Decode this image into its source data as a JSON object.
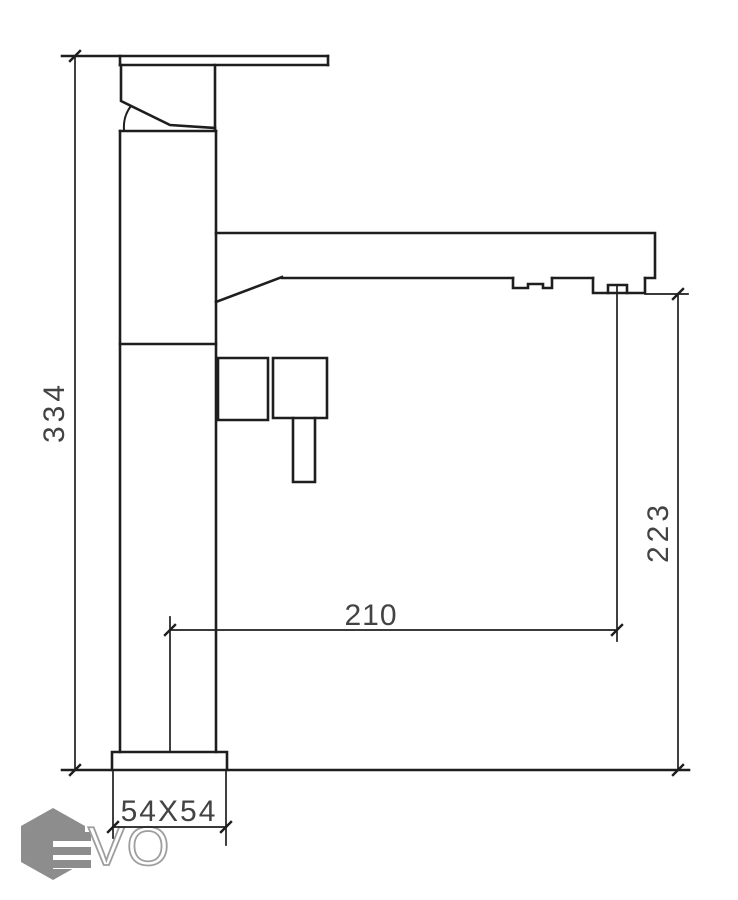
{
  "drawing": {
    "dimension_labels": {
      "total_height": "334",
      "outlet_height": "223",
      "spout_reach": "210",
      "base_size": "54X54"
    },
    "logo": {
      "letters": "VO"
    },
    "colors": {
      "line": "#1e1e1e",
      "dimension_text": "#434343",
      "logo_gray": "#8d8d8d",
      "logo_outline": "#9e9e9e",
      "background": "#ffffff"
    }
  }
}
